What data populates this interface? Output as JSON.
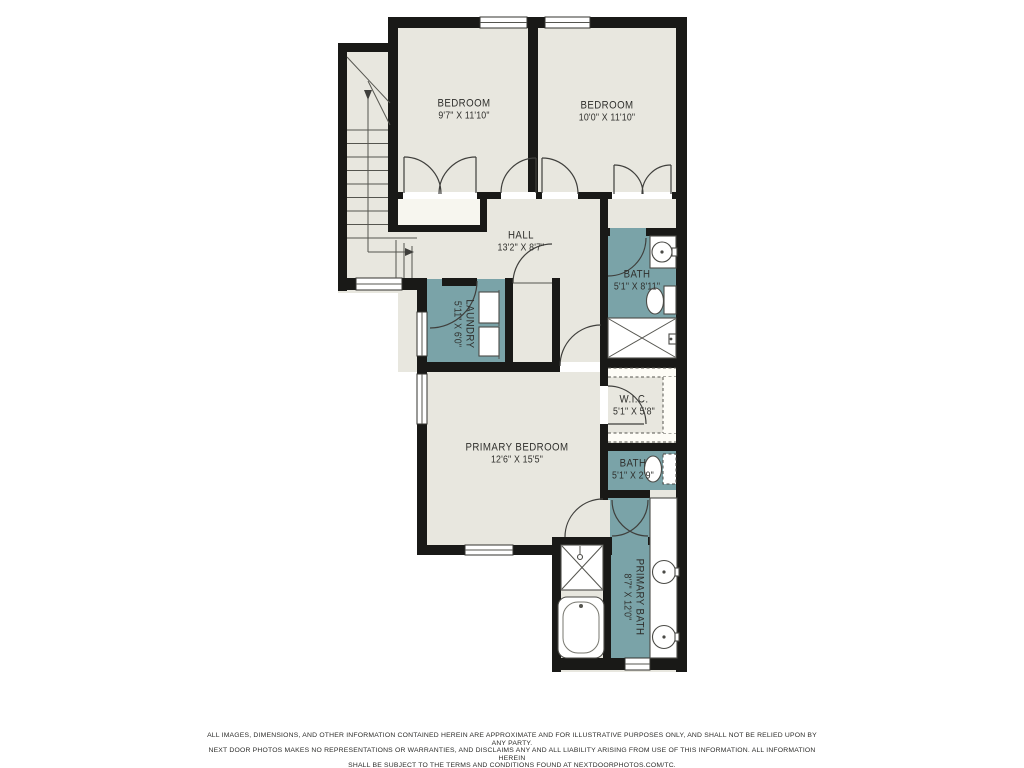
{
  "rooms": {
    "bedroom_left": {
      "name": "BEDROOM",
      "dims": "9'7\" X 11'10\""
    },
    "bedroom_right": {
      "name": "BEDROOM",
      "dims": "10'0\" X 11'10\""
    },
    "hall": {
      "name": "HALL",
      "dims": "13'2\" X 8'7\""
    },
    "laundry": {
      "name": "LAUNDRY",
      "dims": "5'11\" X 6'0\""
    },
    "bath": {
      "name": "BATH",
      "dims": "5'1\" X 8'11\""
    },
    "wic": {
      "name": "W.I.C.",
      "dims": "5'1\" X 5'8\""
    },
    "bath_small": {
      "name": "BATH",
      "dims": "5'1\" X 2'9\""
    },
    "primary_bedroom": {
      "name": "PRIMARY BEDROOM",
      "dims": "12'6\" X 15'5\""
    },
    "primary_bath": {
      "name": "PRIMARY BATH",
      "dims": "8'7\" X 12'0\""
    }
  },
  "colors": {
    "floor": "#e8e7df",
    "wall": "#191917",
    "wet": "#7aa3a8",
    "line": "#3f3f3c",
    "txt": "#2f2f2c"
  },
  "disclaimer": {
    "line1": "ALL IMAGES, DIMENSIONS, AND OTHER INFORMATION CONTAINED HEREIN ARE APPROXIMATE AND FOR ILLUSTRATIVE PURPOSES ONLY, AND SHALL NOT BE RELIED UPON BY ANY PARTY.",
    "line2": "NEXT DOOR PHOTOS MAKES NO REPRESENTATIONS OR WARRANTIES, AND DISCLAIMS ANY AND ALL LIABILITY ARISING FROM USE OF THIS INFORMATION. ALL INFORMATION HEREIN",
    "line3": "SHALL BE SUBJECT TO THE TERMS AND CONDITIONS FOUND AT NEXTDOORPHOTOS.COM/TC."
  }
}
